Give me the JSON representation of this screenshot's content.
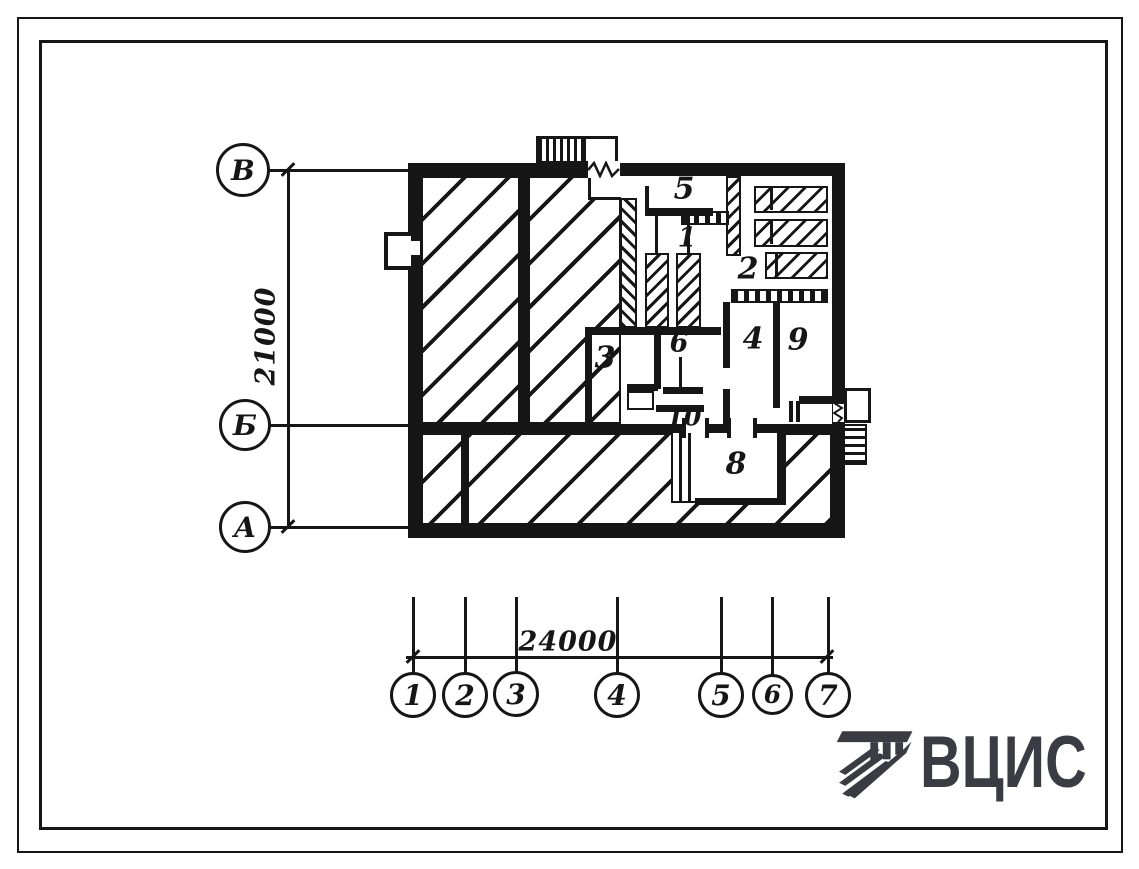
{
  "plan": {
    "dims": {
      "vertical": "21000",
      "horizontal": "24000"
    },
    "row_axes": [
      {
        "label": "В"
      },
      {
        "label": "Б"
      },
      {
        "label": "А"
      }
    ],
    "col_axes": [
      {
        "label": "1"
      },
      {
        "label": "2"
      },
      {
        "label": "3"
      },
      {
        "label": "4"
      },
      {
        "label": "5"
      },
      {
        "label": "6"
      },
      {
        "label": "7"
      }
    ],
    "rooms": [
      {
        "name": "room-5",
        "number": "5"
      },
      {
        "name": "room-1",
        "number": "1"
      },
      {
        "name": "room-2",
        "number": "2"
      },
      {
        "name": "room-3",
        "number": "3"
      },
      {
        "name": "room-6",
        "number": "6"
      },
      {
        "name": "room-4",
        "number": "4"
      },
      {
        "name": "room-9",
        "number": "9"
      },
      {
        "name": "room-10",
        "number": "10"
      },
      {
        "name": "room-8",
        "number": "8"
      }
    ]
  },
  "branding": {
    "logo_text": "ВЦИС"
  },
  "colors": {
    "ink": "#161616",
    "logo": "#3b3b44",
    "paper": "#ffffff"
  }
}
